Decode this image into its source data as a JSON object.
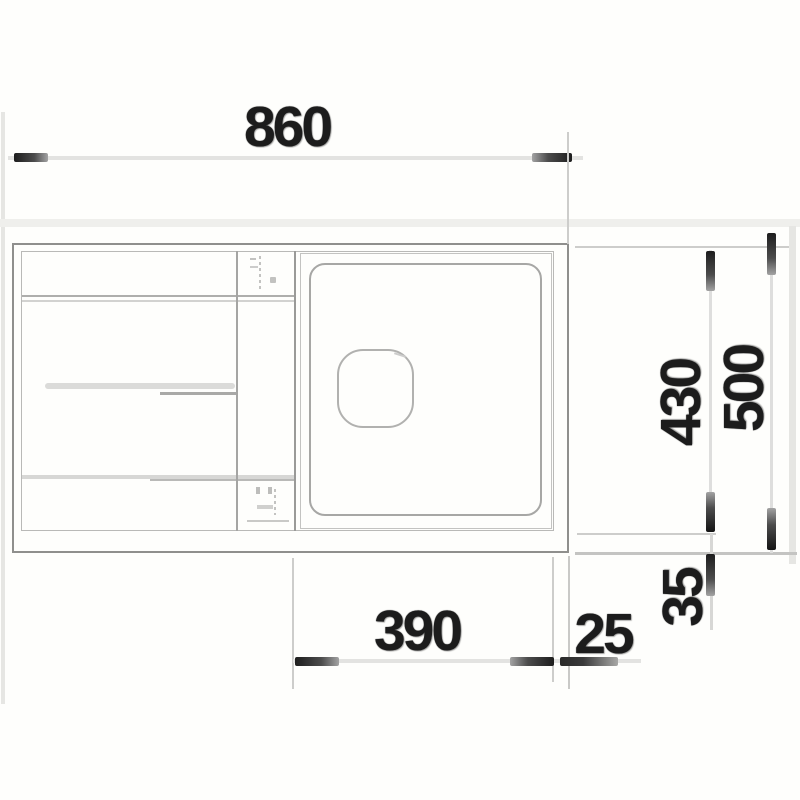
{
  "drawing": {
    "title": "Sink technical drawing - top view",
    "dimensions": {
      "overall_width_mm": "860",
      "overall_depth_mm": "500",
      "bowl_inner_depth_mm": "430",
      "bowl_inner_width_mm": "390",
      "bowl_edge_gap_mm": "25",
      "bowl_front_gap_mm": "35"
    },
    "colors": {
      "background": "#fefefc",
      "drawing_line_gray": "#8f8f8d",
      "light_line_gray": "#c3c3c1",
      "dimension_text": "#1c1c1c",
      "arrow_dark": "#1d1d1d"
    }
  }
}
